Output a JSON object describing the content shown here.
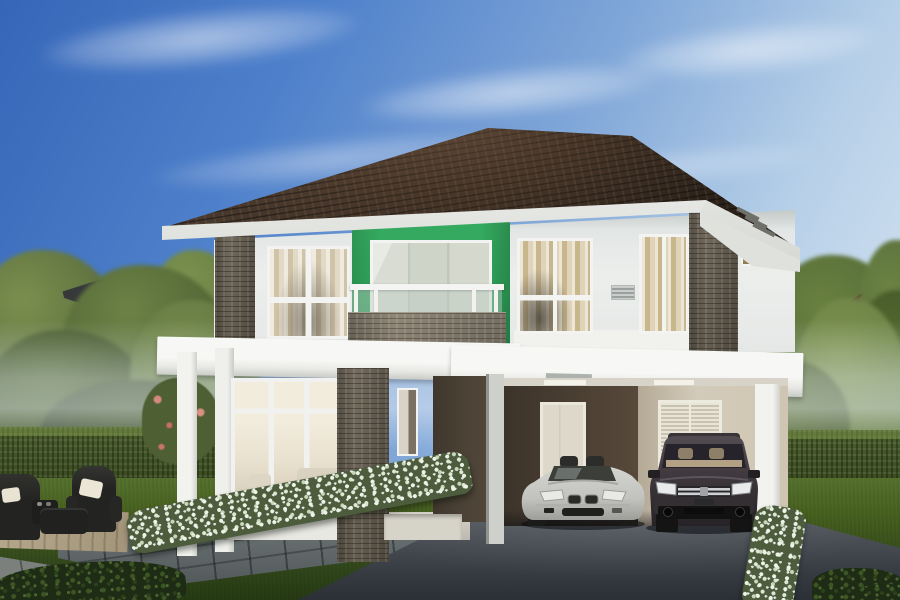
{
  "image": {
    "kind": "architectural rendering",
    "subject": "modern two-storey detached house with double carport, garden and two parked cars"
  },
  "palette": {
    "sky-top": "#3566b8",
    "sky-mid": "#7fa6d8",
    "sky-horizon": "#e0ebf4",
    "roof-dark": "#261d16",
    "roof-mid": "#3a2c21",
    "fascia": "#eef0ec",
    "wall-light": "#eceeec",
    "green-accent": "#2fa55b",
    "stone": "#8b8274",
    "slab-white": "#f4f5f2",
    "frame-white": "#f3f4f2",
    "curtain-tan": "#c9b68d",
    "entry-wall": "#594f42",
    "carport-wall-dark": "#4c4134",
    "carport-wall-light": "#cfc7b6",
    "door-white": "#e9e4d6",
    "hedge-green": "#46592e",
    "lawn-green": "#4c662e",
    "drive-asphalt": "#363b42",
    "paver-grey": "#666d6e",
    "deck-tan": "#b3a489",
    "flower-white": "#edf2e6",
    "car-silver": "#c7c8c3",
    "car-dark-suv": "#3a3439",
    "furniture-dark": "#242422",
    "cushion-cream": "#ece6d7"
  },
  "scene": {
    "sky": {
      "clouds": 5
    },
    "house": {
      "storeys": 2,
      "roof": "dark brown hipped tile roof with white fascia",
      "accent_panel": "green painted balcony surround",
      "balcony": "white railing with glass infill over stone-clad parapet",
      "second_floor_windows": 3,
      "right_wing_small_windows": 2,
      "ground_floor": [
        "full-height living room glazing",
        "recessed entry porch with narrow window",
        "double carport"
      ],
      "carport": {
        "rear_left": "white single door",
        "rear_right": "white louvered doors",
        "pillars": "white"
      }
    },
    "vehicles": [
      {
        "type": "silver roadster",
        "position": "left carport bay"
      },
      {
        "type": "dark grey SUV",
        "position": "right carport bay"
      }
    ],
    "garden": {
      "hedges": "clipped hedges left and right",
      "flower_borders": "white flowering borders along driveway edges",
      "flower_bush_pink": "pink flowering shrub at left of house",
      "furniture": "dark wicker armchairs with cream cushions on tan deck",
      "paving": "grey paver walkway, paver terrace at lower left",
      "driveway": "dark asphalt driveway"
    },
    "background": {
      "left": "neighbouring dark roof corner among trees",
      "right": "neighbouring brown-roof house among trees"
    }
  }
}
